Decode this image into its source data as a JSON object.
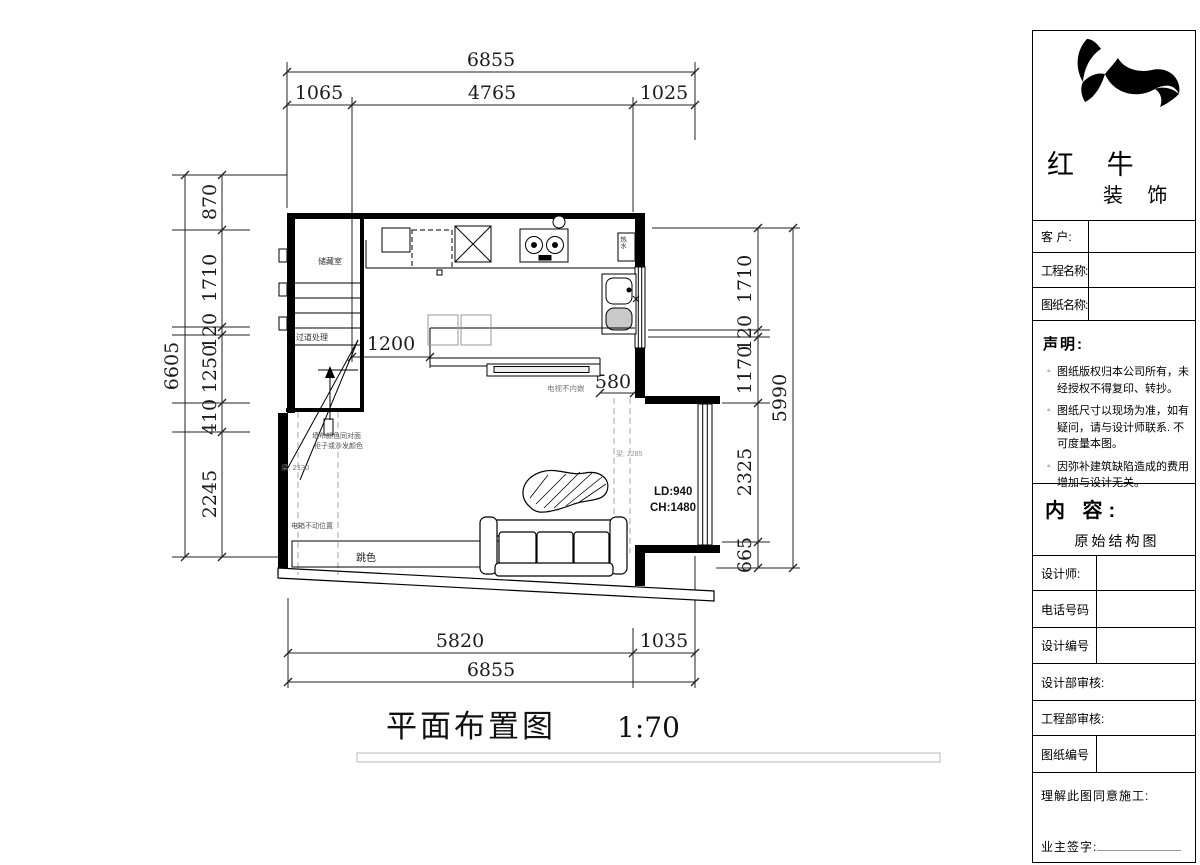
{
  "colors": {
    "ink": "#000000",
    "gray_text": "#777777",
    "beam_dash": "#b5b5b5",
    "bar_border": "#b9b9b9"
  },
  "plan": {
    "title": "平面布置图",
    "scale": "1:70",
    "dims": {
      "top_total": "6855",
      "top_seg_1": "1065",
      "top_seg_2": "4765",
      "top_seg_3": "1025",
      "left_total": "6605",
      "left_seg_1": "870",
      "left_seg_2": "1710",
      "left_seg_3": "120",
      "left_seg_4": "1250",
      "left_seg_5": "410",
      "left_seg_6": "2245",
      "right_total": "5990",
      "right_seg_1": "1710",
      "right_seg_2": "120",
      "right_seg_3": "1170",
      "right_seg_4": "2325",
      "right_seg_5": "665",
      "bottom_seg_1": "5820",
      "bottom_seg_2": "1035",
      "bottom_total": "6855",
      "corridor": "1200",
      "passage": "580"
    },
    "labels": {
      "storage": "储藏室",
      "corridor_note": "过道处理",
      "wall_note_1": "墙布颜色同对面",
      "wall_note_2": "柜子或沙发颜色",
      "beam_left": "梁: 2130",
      "beam_right": "梁: 2285",
      "tv_note": "电视不内嵌",
      "window_ld": "LD:940",
      "window_ch": "CH:1480",
      "elec_note": "电箱不动位置",
      "accent_note": "跳色",
      "heater": "热水"
    }
  },
  "title_block": {
    "brand_line1": "红 牛",
    "brand_line2": "装 饰",
    "customer": "客  户:",
    "project_name": "工程名称:",
    "drawing_name": "图纸名称:",
    "statement_title": "声明:",
    "statement_items": [
      "图纸版权归本公司所有，未经授权不得复印、转抄。",
      "图纸尺寸以现场为准，如有疑问，请与设计师联系. 不可度量本图。",
      "因弥补建筑缺陷造成的费用增加与设计无关。"
    ],
    "content_title": "内 容:",
    "content_value": "原始结构图",
    "designer": "设计师:",
    "phone": "电话号码",
    "design_no": "设计编号",
    "design_dept": "设计部审核:",
    "eng_dept": "工程部审核:",
    "drawing_no": "图纸编号",
    "agreement": "理解此图同意施工:",
    "owner_sign": "业主签字:"
  }
}
